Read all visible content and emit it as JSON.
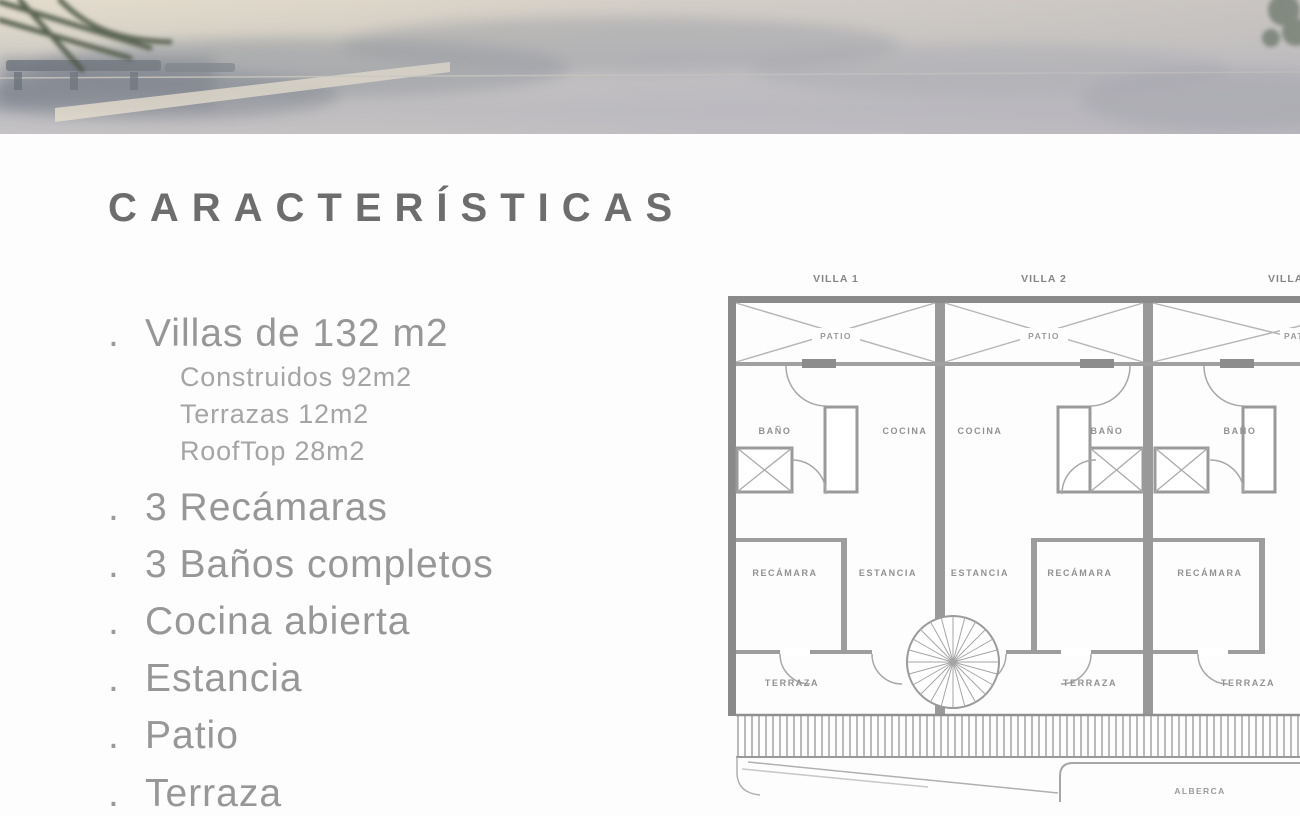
{
  "content": {
    "title": "CARACTERÍSTICAS",
    "bullet": ".",
    "features": [
      {
        "label": "Villas de 132 m2",
        "sub": [
          "Construidos 92m2",
          "Terrazas 12m2",
          "RoofTop 28m2"
        ]
      },
      {
        "label": "3 Recámaras"
      },
      {
        "label": "3 Baños completos"
      },
      {
        "label": "Cocina abierta"
      },
      {
        "label": "Estancia"
      },
      {
        "label": "Patio"
      },
      {
        "label": "Terraza"
      }
    ]
  },
  "floorplan": {
    "villa_labels": [
      "VILLA 1",
      "VILLA 2",
      "VILLA 3"
    ],
    "patio_labels": [
      "PATIO",
      "PATIO",
      "PATIO"
    ],
    "bano_labels": [
      "BAÑO",
      "BAÑO",
      "BAÑO"
    ],
    "cocina_labels": [
      "COCINA",
      "COCINA"
    ],
    "estancia_labels": [
      "ESTANCIA",
      "ESTANCIA"
    ],
    "recamara_labels": [
      "RECÁMARA",
      "RECÁMARA",
      "RECÁMARA"
    ],
    "terraza_labels": [
      "TERRAZA",
      "TERRAZA",
      "TERRAZA"
    ],
    "alberca_label": "ALBERCA"
  },
  "colors": {
    "title_text": "#6d6d6d",
    "body_text": "#979797",
    "plan_walls": "#8a8a8a",
    "plan_lines": "#a6a6a6",
    "photo_pavement": "#d8d3c8",
    "photo_shadow": "#848b95",
    "palm_green": "#3c5330"
  }
}
